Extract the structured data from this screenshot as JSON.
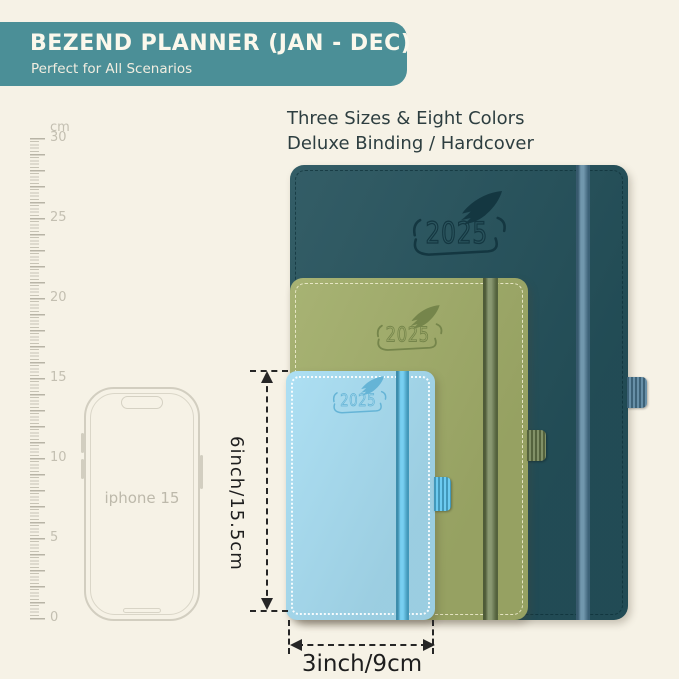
{
  "background_color": "#f6f2e6",
  "header": {
    "title": "BEZEND PLANNER (JAN - DEC)",
    "subtitle": "Perfect for All Scenarios",
    "bg_color": "#4b8f97",
    "text_color": "#fbf8ec"
  },
  "headline": {
    "line1": "Three Sizes & Eight Colors",
    "line2": "Deluxe Binding / Hardcover",
    "color": "#2d3e40"
  },
  "ruler": {
    "unit_label": "cm",
    "labels": [
      {
        "text": "cm",
        "cm": null
      },
      {
        "text": "30",
        "cm": 30
      },
      {
        "text": "25",
        "cm": 25
      },
      {
        "text": "20",
        "cm": 20
      },
      {
        "text": "15",
        "cm": 15
      },
      {
        "text": "10",
        "cm": 10
      },
      {
        "text": "5",
        "cm": 5
      },
      {
        "text": "0",
        "cm": 0
      }
    ],
    "tick_color": "#c7c3b5"
  },
  "phone": {
    "label": "iphone 15",
    "outline_color": "#d2cec0"
  },
  "planners": [
    {
      "size": "large",
      "year": "2025",
      "colors": {
        "cover": "#24515b",
        "band": "#4e7d99",
        "deboss": "#143741",
        "stitch": "rgba(12,45,53,0.65)"
      }
    },
    {
      "size": "medium",
      "year": "2025",
      "colors": {
        "cover": "#a1ad69",
        "band": "#6c7e4e",
        "deboss": "#75854b",
        "stitch": "rgba(248,244,218,0.8)"
      }
    },
    {
      "size": "small",
      "year": "2025",
      "colors": {
        "cover": "#a7ddf2",
        "band": "#55c3ee",
        "deboss": "#65b4d6",
        "stitch": "rgba(255,255,255,0.9)"
      }
    }
  ],
  "dimensions": {
    "height_label": "6inch/15.5cm",
    "width_label": "3inch/9cm",
    "line_color": "#262626"
  }
}
